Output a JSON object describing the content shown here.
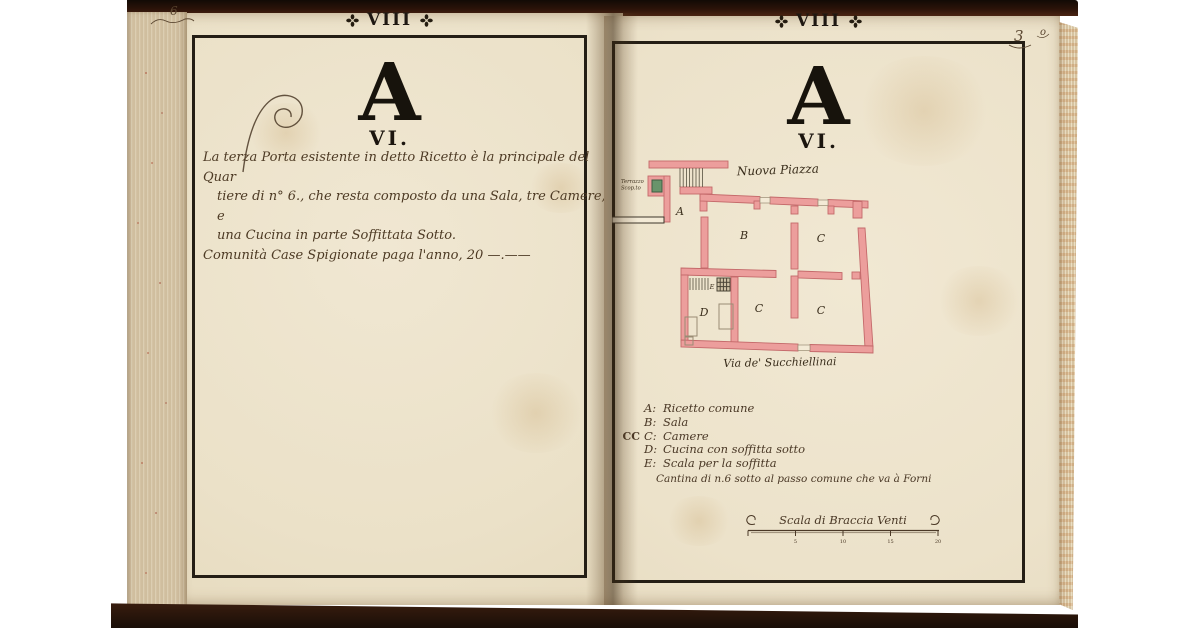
{
  "colors": {
    "background": "#ffffff",
    "cover_brown": "#2b1309",
    "paper": "#ece2cb",
    "frame_ink": "#241e15",
    "print_ink": "#1b150e",
    "hand_ink": "#4d3a24",
    "plan_wall_fill": "#ec9e9c",
    "plan_wall_stroke": "#c4696a",
    "terrace_window_green": "#69946b"
  },
  "left_page": {
    "folio_mark": "6",
    "header_numeral": "VIII",
    "letter": "A",
    "section_numeral": "VI.",
    "paragraph_lines": [
      "La terza Porta esistente in detto Ricetto è la principale del Quar",
      "tiere di n° 6., che resta composto da una Sala, tre Camere, e",
      "una Cucina in parte Soffittata Sotto."
    ],
    "footer_line": "Comunità Case Spigionate paga l'anno, 20 —.——"
  },
  "right_page": {
    "folio_mark_1": "3",
    "folio_mark_2": "o",
    "header_numeral": "VIII",
    "letter": "A",
    "section_numeral": "VI.",
    "plan": {
      "street_top": "Nuova Piazza",
      "street_bottom": "Via de' Succhiellinai",
      "terrace_line1": "Terrazzo",
      "terrace_line2": "Scop.to",
      "rooms": {
        "a": "A",
        "b": "B",
        "c_upper": "C",
        "c_mid": "C",
        "c_right": "C",
        "d": "D",
        "e": "E"
      }
    },
    "legend": {
      "rows": [
        {
          "prefix": "",
          "key": "A:",
          "text": "Ricetto comune"
        },
        {
          "prefix": "",
          "key": "B:",
          "text": "Sala"
        },
        {
          "prefix": "CC",
          "key": "C:",
          "text": "Camere"
        },
        {
          "prefix": "",
          "key": "D:",
          "text": "Cucina con soffitta sotto"
        },
        {
          "prefix": "",
          "key": "E:",
          "text": "Scala per la soffitta"
        }
      ],
      "note": "Cantina di n.6 sotto al passo comune che va à Forni"
    },
    "scale_bar": {
      "label": "Scala di Braccia Venti",
      "ticks": [
        "5",
        "10",
        "15",
        "20"
      ]
    }
  }
}
